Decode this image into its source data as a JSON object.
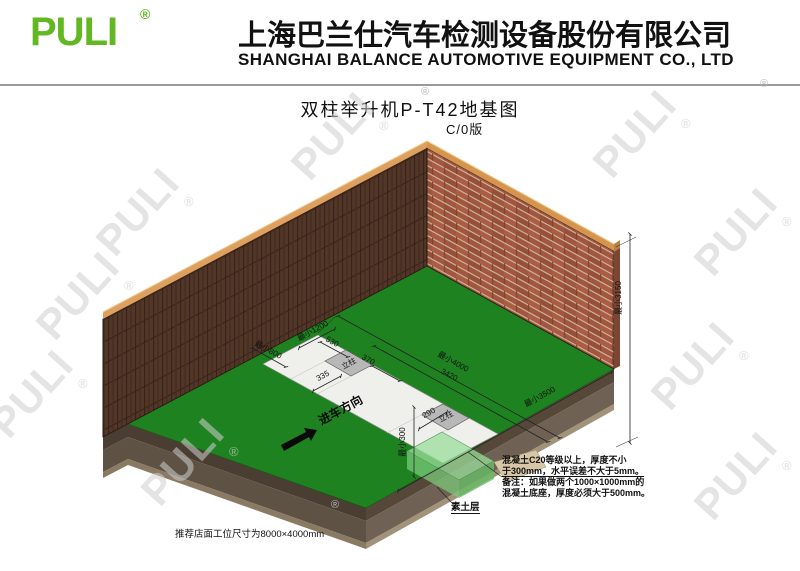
{
  "header": {
    "logo_text": "PULI",
    "registered_mark": "®",
    "company_name_cn": "上海巴兰仕汽车检测设备股份有限公司",
    "company_name_en": "SHANGHAI BALANCE AUTOMOTIVE EQUIPMENT CO., LTD"
  },
  "title": {
    "drawing_title": "双柱举升机P-T42地基图",
    "revision": "C/0版"
  },
  "diagram": {
    "dimensions": {
      "strip_width_min": "最小1200",
      "pad_offset": "530",
      "pad_length": "370",
      "pad_width_left": "335",
      "pad_spacing": "3420",
      "strip_length_min": "最小4000",
      "wall_clearance_min": "最小800",
      "front_clearance_min": "最小300",
      "pad_width_right": "290",
      "room_width_min": "最小3500",
      "ceiling_height_min": "最小3150"
    },
    "labels": {
      "column_1": "立柱",
      "column_2": "立柱",
      "drive_in_direction": "进车方向",
      "soil_layer": "素土层"
    },
    "notes": {
      "concrete_spec_line1": "混凝土C20等级以上，厚度不小",
      "concrete_spec_line2": "于300mm，水平误差不大于5mm。",
      "remark_line1": "备注：如果做两个1000×1000mm的",
      "remark_line2": "混凝土底座，厚度必须大于500mm。"
    },
    "footnote": "推荐店面工位尺寸为8000×4000mm"
  },
  "watermark": {
    "text": "PULI",
    "registered_mark": "®"
  },
  "colors": {
    "brand_green": "#62b822",
    "floor_green": "#1f8220",
    "wall_left_brick": "#523628",
    "wall_right_brick": "#a1563f",
    "wall_coping": "#db9b5c",
    "foundation_strip": "#efefec",
    "column_pad": "#b8b8b8",
    "soil_dark": "#564839",
    "soil_mid": "#6f6254",
    "concrete_cube": "#8cd08c"
  }
}
